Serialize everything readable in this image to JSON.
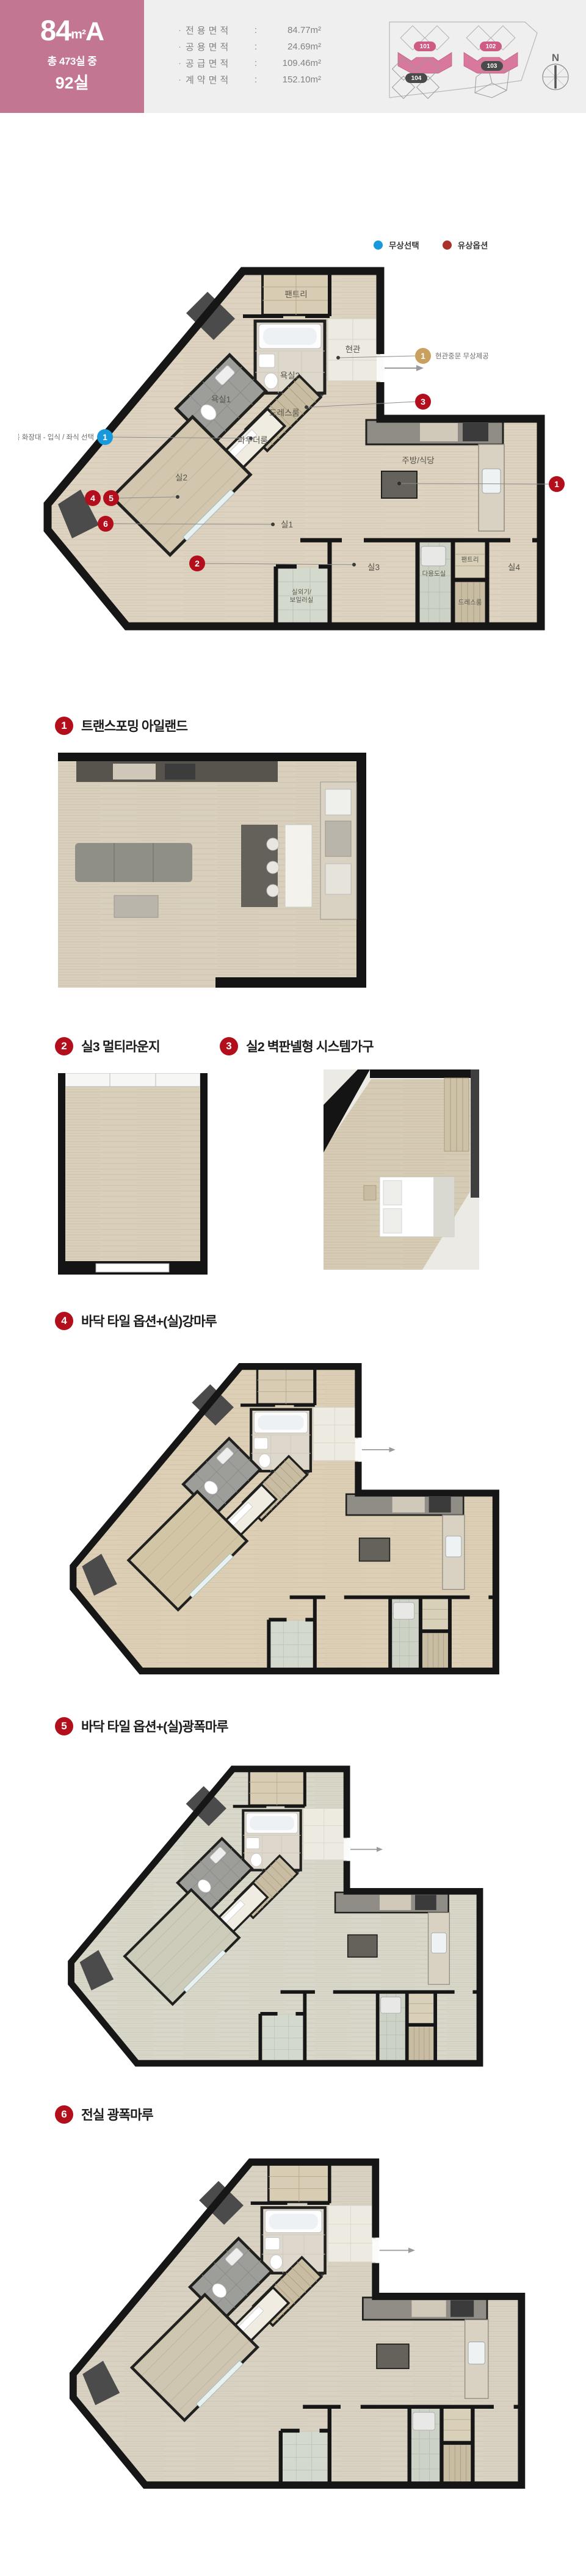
{
  "header": {
    "bullet": "·",
    "type": {
      "num": "84",
      "unit": "m²",
      "suffix": "A"
    },
    "subtitle_line1": "총 473실 중",
    "subtitle_line2": "92실",
    "areas": [
      {
        "label": "전용면적",
        "value": "84.77m²"
      },
      {
        "label": "공용면적",
        "value": "24.69m²"
      },
      {
        "label": "공급면적",
        "value": "109.46m²"
      },
      {
        "label": "계약면적",
        "value": "152.10m²"
      }
    ],
    "sitemap": {
      "buildings": [
        {
          "id": "101",
          "highlighted": true
        },
        {
          "id": "102",
          "highlighted": true
        },
        {
          "id": "103",
          "highlighted": false
        },
        {
          "id": "104",
          "highlighted": false
        }
      ],
      "compass": "N",
      "highlight_color": "#d7789c",
      "badge_pink": "#ce5b84",
      "badge_gray": "#4a4a4a"
    },
    "colors": {
      "band_pink": "#c27691",
      "bg_gray": "#efeff0"
    }
  },
  "legend": {
    "items": [
      {
        "label": "무상선택",
        "color": "#1899dc"
      },
      {
        "label": "유상옵션",
        "color": "#a8322a"
      }
    ]
  },
  "floorplan": {
    "rooms": {
      "pantry1": "팬트리",
      "entrance": "현관",
      "bath2": "욕실2",
      "bath1": "욕실1",
      "dress1": "드레스룸",
      "powder": "파우더룸",
      "room2": "실2",
      "room1": "실1",
      "kitchen": "주방/식당",
      "room3": "실3",
      "room4": "실4",
      "utility": "다용도실",
      "pantry2": "팬트리",
      "dress2": "드레스룸",
      "boiler_l1": "실외기/",
      "boiler_l2": "보일러실"
    },
    "callouts": {
      "c1_blue": {
        "num": "1",
        "label": "파우더룸 화장대 - 입식 / 좌식 선택",
        "color": "#1899dc"
      },
      "c1_gold": {
        "num": "1",
        "label": "현관중문 무상제공",
        "color": "#c9a05e"
      },
      "c1_red": {
        "num": "1",
        "color": "#b30e1c"
      },
      "c2": {
        "num": "2",
        "color": "#b30e1c"
      },
      "c3": {
        "num": "3",
        "color": "#b30e1c"
      },
      "c4": {
        "num": "4",
        "color": "#b30e1c"
      },
      "c5": {
        "num": "5",
        "color": "#b30e1c"
      },
      "c6": {
        "num": "6",
        "color": "#b30e1c"
      }
    },
    "floor_colors": {
      "main_wood": "#ddd3c0",
      "opt4_wood": "#dccfb6",
      "opt5_wood": "#d8d7c9",
      "opt6_wood": "#d9d2c3"
    }
  },
  "sections": [
    {
      "num": "1",
      "title": "트랜스포밍 아일랜드"
    },
    {
      "num": "2",
      "title": "실3 멀티라운지"
    },
    {
      "num": "3",
      "title": "실2 벽판넬형 시스템가구"
    },
    {
      "num": "4",
      "title": "바닥 타일 옵션+(실)강마루"
    },
    {
      "num": "5",
      "title": "바닥 타일 옵션+(실)광폭마루"
    },
    {
      "num": "6",
      "title": "전실 광폭마루"
    }
  ]
}
